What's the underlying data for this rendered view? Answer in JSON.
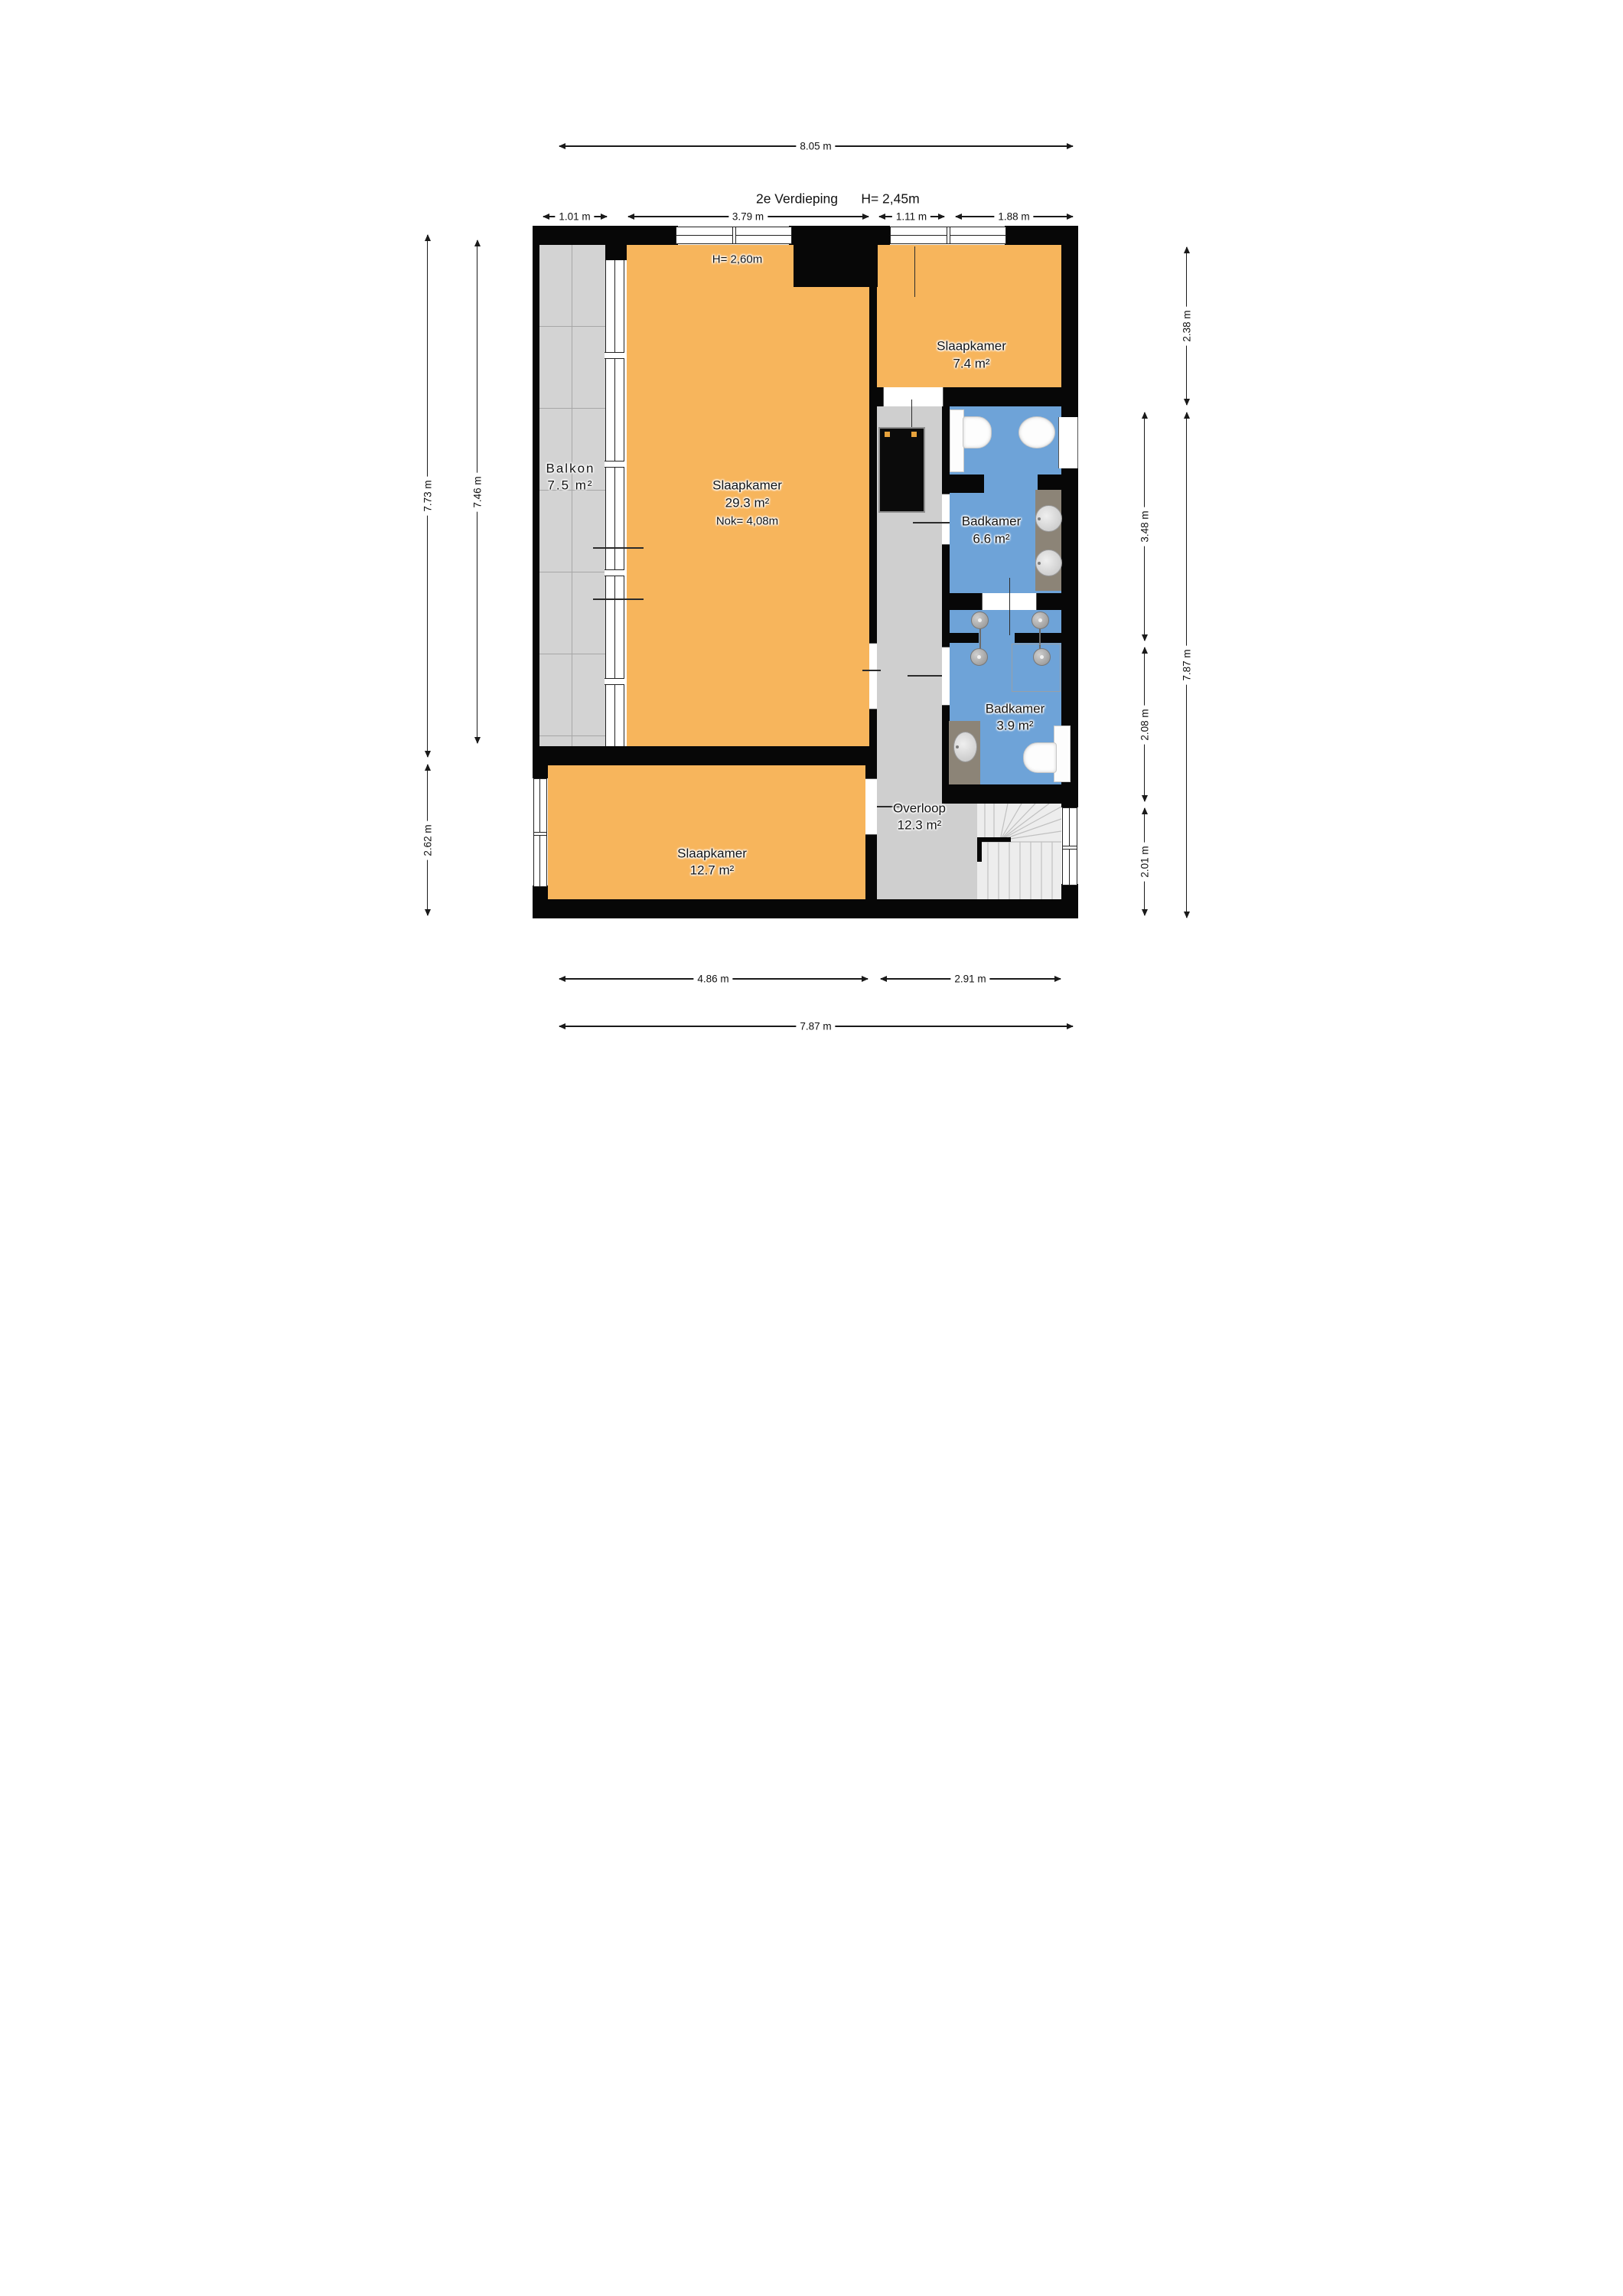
{
  "title": {
    "floor_label": "2e Verdieping",
    "ceiling_height": "H= 2,45m"
  },
  "plan": {
    "annotations": {
      "main_room_ceiling": "H= 2,60m"
    },
    "rooms": [
      {
        "name": "Balkon",
        "area": "7.5 m²"
      },
      {
        "name": "Slaapkamer",
        "area": "29.3 m²",
        "note": "Nok= 4,08m"
      },
      {
        "name": "Slaapkamer",
        "area": "7.4 m²"
      },
      {
        "name": "Badkamer",
        "area": "6.6 m²"
      },
      {
        "name": "Badkamer",
        "area": "3.9 m²"
      },
      {
        "name": "Overloop",
        "area": "12.3 m²"
      },
      {
        "name": "Slaapkamer",
        "area": "12.7 m²"
      }
    ],
    "fixtures": [
      "toilet",
      "bidet",
      "double-washbasin",
      "shower",
      "shower",
      "washbasin",
      "toilet",
      "winder-staircase",
      "closet"
    ],
    "colors": {
      "room_fill": "#f7b55c",
      "bathroom_fill": "#6ea3d8",
      "balcony_fill": "#d3d3d3",
      "hall_fill": "#cfcfcf",
      "stairs_fill": "#ededed",
      "wall": "#070707",
      "counter": "#8c8477",
      "closet_handle": "#e7a23c"
    }
  },
  "dimensions": {
    "top_total": "8.05 m",
    "top_segments": [
      "1.01 m",
      "3.79 m",
      "1.11 m",
      "1.88 m"
    ],
    "left": [
      "7.73 m",
      "7.46 m",
      "2.62 m"
    ],
    "right": [
      "2.38 m",
      "3.48 m",
      "2.08 m",
      "2.01 m",
      "7.87 m"
    ],
    "bottom_segments": [
      "4.86 m",
      "2.91 m"
    ],
    "bottom_total": "7.87 m"
  }
}
